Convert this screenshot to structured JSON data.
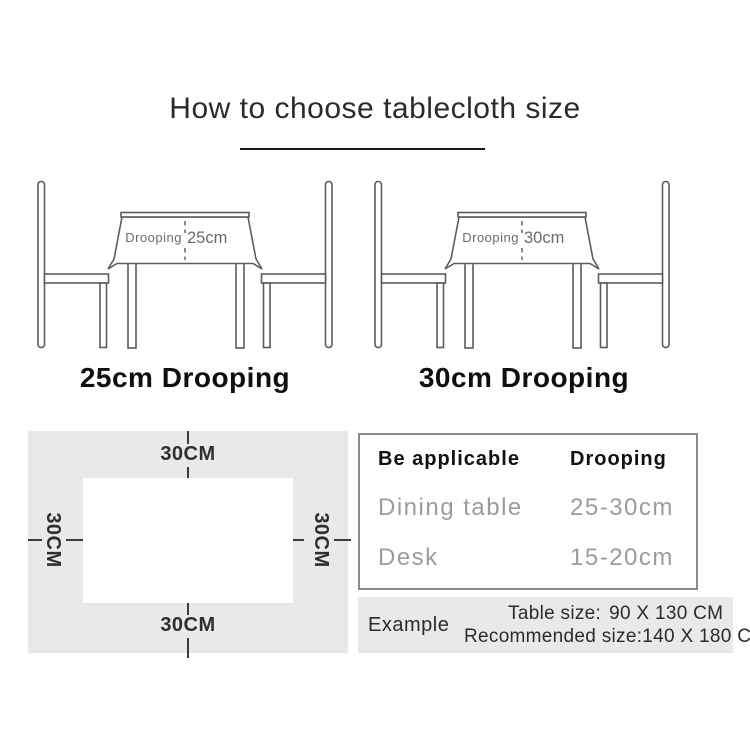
{
  "title": {
    "text": "How to choose tablecloth size"
  },
  "illustrations": [
    {
      "drooping_text": "Drooping",
      "drooping_value": "25cm",
      "caption": "25cm Drooping"
    },
    {
      "drooping_text": "Drooping",
      "drooping_value": "30cm",
      "caption": "30cm Drooping"
    }
  ],
  "size_diagram": {
    "top_label": "30CM",
    "bottom_label": "30CM",
    "left_label": "30CM",
    "right_label": "30CM"
  },
  "spec_table": {
    "header": {
      "col1": "Be applicable",
      "col2": "Drooping"
    },
    "rows": [
      {
        "name": "Dining table",
        "value": "25-30cm"
      },
      {
        "name": "Desk",
        "value": "15-20cm"
      }
    ]
  },
  "example": {
    "label": "Example",
    "lines": [
      {
        "label": "Table size:",
        "value": "90 X 130 CM"
      },
      {
        "label": "Recommended size:",
        "value": "140 X 180 CM"
      }
    ]
  },
  "colors": {
    "line_art": "#5c5c5c",
    "panel_bg": "#e9e9e9",
    "muted_text": "#9c9c9c",
    "ink": "#1a1a1a",
    "border_gray": "#8a8a8a"
  }
}
